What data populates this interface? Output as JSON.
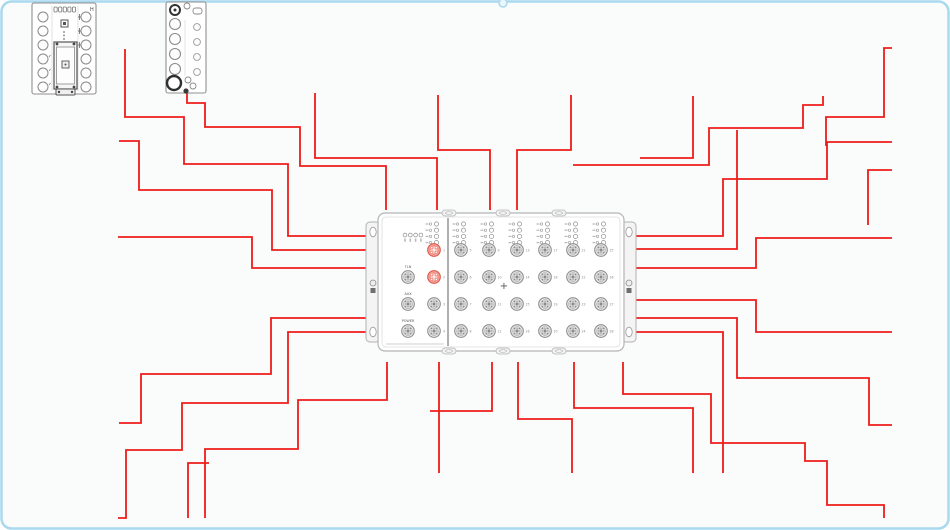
{
  "canvas": {
    "width": 950,
    "height": 530,
    "background": "#fafbfb",
    "border_color": "#a9d9ef",
    "wire_color": "#ee1c1a",
    "device_stroke": "#9a9a9a",
    "highlight_fill": "#f5a79e",
    "highlight_stroke": "#e05548",
    "top_connector_nub_x": 503
  },
  "devices": {
    "module1": {
      "x": 32,
      "y": 3,
      "w": 64,
      "h": 91,
      "corner_mark": "H"
    },
    "module2": {
      "x": 166,
      "y": 2,
      "w": 40,
      "h": 91
    },
    "junction_box": {
      "x": 378,
      "y": 213,
      "w": 246,
      "h": 138,
      "side_ports": [
        {
          "label": "TLN"
        },
        {
          "label": "AUX"
        },
        {
          "label": "POWER"
        }
      ],
      "service_ports": [
        {
          "number": 1,
          "highlighted": true
        },
        {
          "number": 2,
          "highlighted": true
        },
        {
          "number": 3,
          "highlighted": false
        },
        {
          "number": 4,
          "highlighted": false
        }
      ],
      "grid_ports": {
        "rows": 4,
        "cols": 6,
        "numbers": [
          5,
          6,
          7,
          8,
          9,
          10,
          11,
          12,
          13,
          14,
          15,
          16,
          17,
          18,
          19,
          20,
          21,
          22,
          23,
          24,
          25,
          26,
          27,
          28
        ]
      },
      "center_marker": "+"
    }
  },
  "wires": [
    {
      "points": [
        [
          125,
          49
        ],
        [
          125,
          117
        ],
        [
          184,
          117
        ],
        [
          184,
          164
        ],
        [
          288,
          164
        ],
        [
          288,
          236
        ],
        [
          368,
          236
        ]
      ]
    },
    {
      "points": [
        [
          119,
          141
        ],
        [
          139,
          141
        ],
        [
          139,
          190
        ],
        [
          272,
          190
        ],
        [
          272,
          250
        ],
        [
          368,
          250
        ]
      ]
    },
    {
      "points": [
        [
          118,
          237
        ],
        [
          252,
          237
        ],
        [
          252,
          268
        ],
        [
          368,
          268
        ]
      ]
    },
    {
      "points": [
        [
          368,
          318
        ],
        [
          271,
          318
        ],
        [
          271,
          374
        ],
        [
          141,
          374
        ],
        [
          141,
          423
        ],
        [
          119,
          423
        ]
      ]
    },
    {
      "points": [
        [
          368,
          332
        ],
        [
          288,
          332
        ],
        [
          288,
          403
        ],
        [
          182,
          403
        ],
        [
          182,
          450
        ],
        [
          126,
          450
        ],
        [
          126,
          518
        ],
        [
          118,
          518
        ]
      ]
    },
    {
      "points": [
        [
          187,
          93
        ],
        [
          187,
          103
        ],
        [
          205,
          103
        ],
        [
          205,
          127
        ],
        [
          300,
          127
        ],
        [
          300,
          166
        ],
        [
          386,
          166
        ],
        [
          386,
          210
        ]
      ]
    },
    {
      "points": [
        [
          315,
          93
        ],
        [
          315,
          158
        ],
        [
          437,
          158
        ],
        [
          437,
          210
        ]
      ]
    },
    {
      "points": [
        [
          438,
          95
        ],
        [
          438,
          150
        ],
        [
          490,
          150
        ],
        [
          490,
          210
        ]
      ]
    },
    {
      "points": [
        [
          571,
          95
        ],
        [
          571,
          150
        ],
        [
          517,
          150
        ],
        [
          517,
          210
        ]
      ]
    },
    {
      "points": [
        [
          693,
          96
        ],
        [
          693,
          158
        ],
        [
          640,
          158
        ]
      ]
    },
    {
      "points": [
        [
          632,
          236
        ],
        [
          723,
          236
        ],
        [
          723,
          179
        ],
        [
          827,
          179
        ],
        [
          827,
          142
        ],
        [
          892,
          142
        ]
      ]
    },
    {
      "points": [
        [
          823,
          96
        ],
        [
          823,
          105
        ],
        [
          803,
          105
        ],
        [
          803,
          128
        ],
        [
          709,
          128
        ],
        [
          709,
          165
        ],
        [
          573,
          165
        ]
      ]
    },
    {
      "points": [
        [
          632,
          249
        ],
        [
          737,
          249
        ],
        [
          737,
          130
        ]
      ]
    },
    {
      "points": [
        [
          632,
          268
        ],
        [
          756,
          268
        ],
        [
          756,
          238
        ],
        [
          892,
          238
        ]
      ]
    },
    {
      "points": [
        [
          892,
          48
        ],
        [
          884,
          48
        ],
        [
          884,
          117
        ],
        [
          826,
          117
        ],
        [
          826,
          146
        ]
      ]
    },
    {
      "points": [
        [
          892,
          170
        ],
        [
          868,
          170
        ],
        [
          868,
          225
        ]
      ]
    },
    {
      "points": [
        [
          632,
          300
        ],
        [
          756,
          300
        ],
        [
          756,
          332
        ],
        [
          892,
          332
        ]
      ]
    },
    {
      "points": [
        [
          632,
          318
        ],
        [
          737,
          318
        ],
        [
          737,
          378
        ],
        [
          869,
          378
        ],
        [
          869,
          425
        ],
        [
          892,
          425
        ]
      ]
    },
    {
      "points": [
        [
          632,
          332
        ],
        [
          723,
          332
        ],
        [
          723,
          473
        ]
      ]
    },
    {
      "points": [
        [
          387,
          362
        ],
        [
          387,
          400
        ],
        [
          298,
          400
        ],
        [
          298,
          449
        ],
        [
          205,
          449
        ],
        [
          205,
          518
        ]
      ]
    },
    {
      "points": [
        [
          439,
          362
        ],
        [
          439,
          473
        ]
      ]
    },
    {
      "points": [
        [
          492,
          362
        ],
        [
          492,
          411
        ],
        [
          430,
          411
        ]
      ]
    },
    {
      "points": [
        [
          518,
          362
        ],
        [
          518,
          419
        ],
        [
          572,
          419
        ],
        [
          572,
          473
        ]
      ]
    },
    {
      "points": [
        [
          574,
          362
        ],
        [
          574,
          408
        ],
        [
          693,
          408
        ],
        [
          693,
          473
        ]
      ]
    },
    {
      "points": [
        [
          623,
          362
        ],
        [
          623,
          394
        ],
        [
          711,
          394
        ],
        [
          711,
          443
        ],
        [
          805,
          443
        ],
        [
          805,
          461
        ],
        [
          827,
          461
        ],
        [
          827,
          505
        ],
        [
          884,
          505
        ],
        [
          884,
          518
        ]
      ]
    },
    {
      "points": [
        [
          209,
          463
        ],
        [
          188,
          463
        ],
        [
          188,
          518
        ]
      ]
    }
  ]
}
